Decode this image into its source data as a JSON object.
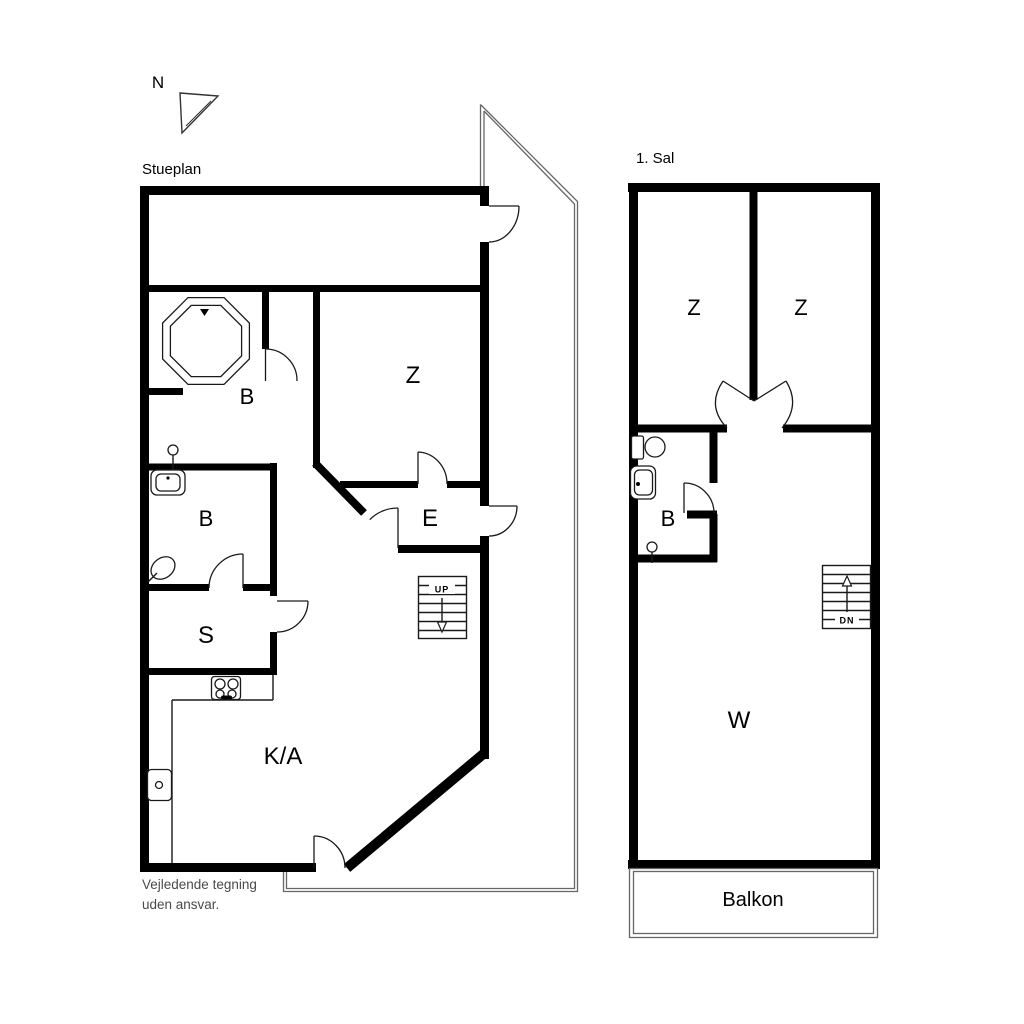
{
  "compass": {
    "label": "N"
  },
  "ground_floor": {
    "title": "Stueplan",
    "rooms": {
      "bathroom_spa": "B",
      "bedroom": "Z",
      "bathroom": "B",
      "entry": "E",
      "storage": "S",
      "kitchen_living": "K/A"
    },
    "stairs_label": "UP"
  },
  "first_floor": {
    "title": "1. Sal",
    "rooms": {
      "bedroom_left": "Z",
      "bedroom_right": "Z",
      "bathroom": "B",
      "living": "W"
    },
    "stairs_label": "DN",
    "balcony_label": "Balkon"
  },
  "disclaimer": {
    "line1": "Vejledende tegning",
    "line2": "uden ansvar."
  },
  "colors": {
    "wall": "#000000",
    "fixture_line": "#1a1a1a",
    "terrace_outline": "#666666",
    "text": "#000000",
    "muted_text": "#4a4a4a",
    "background": "#ffffff"
  }
}
